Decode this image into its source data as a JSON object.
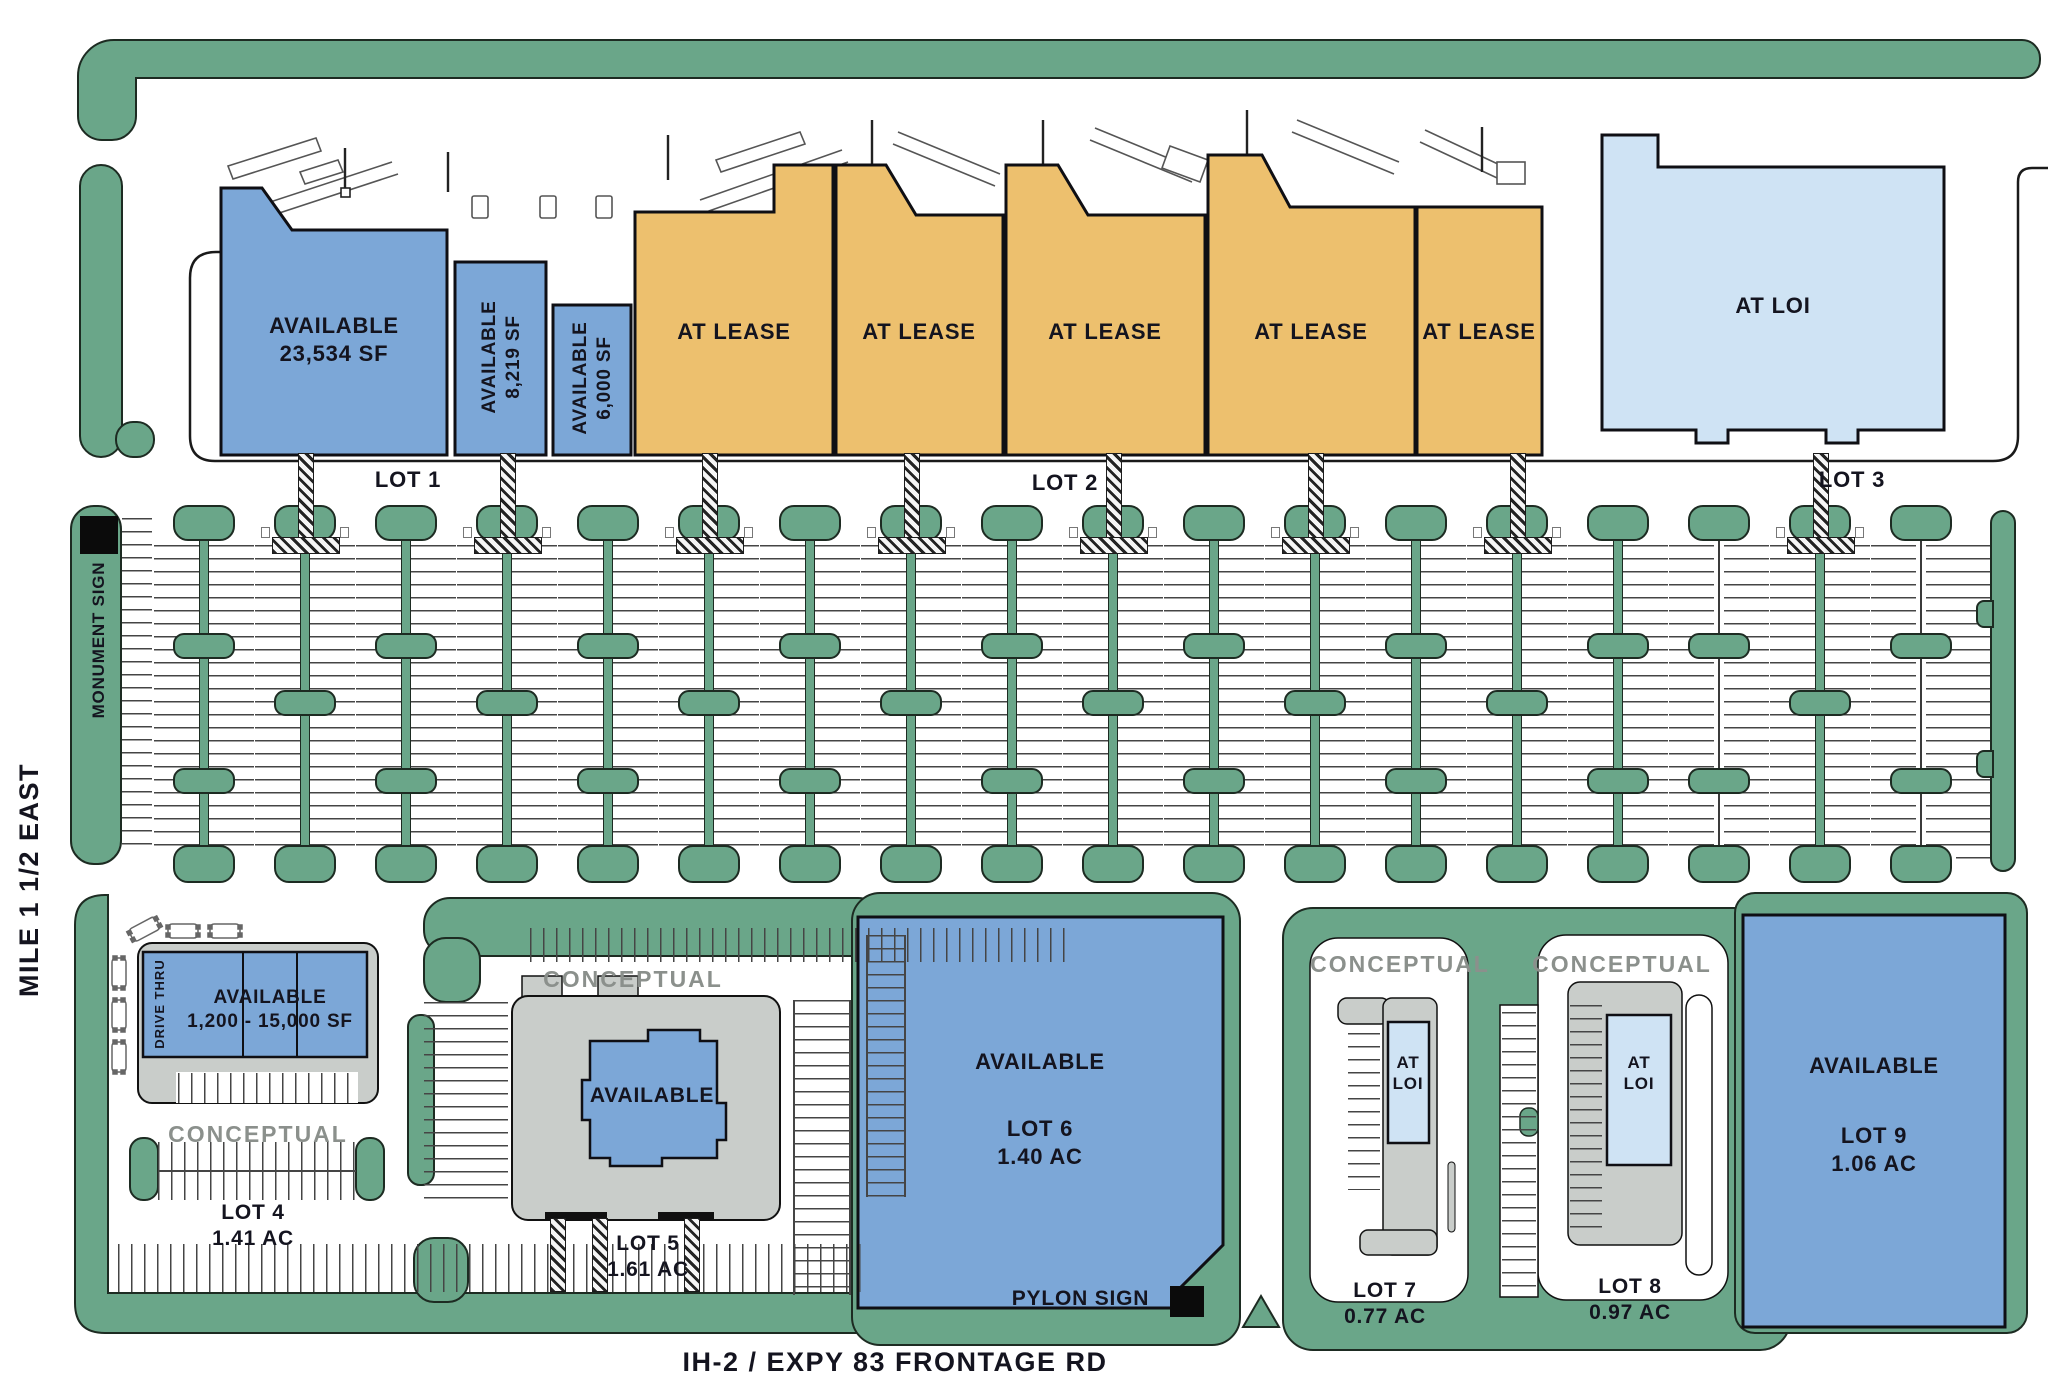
{
  "colors": {
    "available_blue": "#7ca7d7",
    "at_loi_blue": "#cfe3f4",
    "at_lease_orange": "#edc06e",
    "landscape_green": "#6aa689",
    "pad_gray": "#c9cdca",
    "conceptual_gray": "#8b908c",
    "ink": "#14141f"
  },
  "top_row": {
    "building_available_1": {
      "line1": "AVAILABLE",
      "line2": "23,534 SF"
    },
    "building_available_2": {
      "line1": "AVAILABLE",
      "line2": "8,219 SF"
    },
    "building_available_3": {
      "line1": "AVAILABLE",
      "line2": "6,000 SF"
    },
    "at_lease_label": "AT LEASE",
    "at_loi_label": "AT LOI",
    "lot_labels": [
      "LOT 1",
      "LOT 2",
      "LOT 3"
    ]
  },
  "parking": {
    "columns": 18,
    "crosswalk_columns": [
      1,
      3,
      5,
      7,
      9,
      11,
      13,
      16
    ],
    "thin_spine_columns": [
      15,
      17
    ]
  },
  "signs": {
    "monument": "MONUMENT SIGN",
    "pylon": "PYLON SIGN"
  },
  "streets": {
    "west": "MILE 1 1/2 EAST",
    "south": "IH-2 / EXPY 83 FRONTAGE RD"
  },
  "bottom_row": {
    "conceptual_label": "CONCEPTUAL",
    "lot4": {
      "building_line1": "AVAILABLE",
      "building_line2": "1,200 - 15,000 SF",
      "drive_thru": "DRIVE THRU",
      "name": "LOT 4",
      "acreage": "1.41 AC"
    },
    "lot5": {
      "building": "AVAILABLE",
      "name": "LOT 5",
      "acreage": "1.61 AC"
    },
    "lot6": {
      "status": "AVAILABLE",
      "name": "LOT 6",
      "acreage": "1.40 AC"
    },
    "lot7": {
      "building_line1": "AT",
      "building_line2": "LOI",
      "name": "LOT 7",
      "acreage": "0.77 AC"
    },
    "lot8": {
      "building_line1": "AT",
      "building_line2": "LOI",
      "name": "LOT 8",
      "acreage": "0.97 AC"
    },
    "lot9": {
      "status": "AVAILABLE",
      "name": "LOT 9",
      "acreage": "1.06 AC"
    }
  }
}
